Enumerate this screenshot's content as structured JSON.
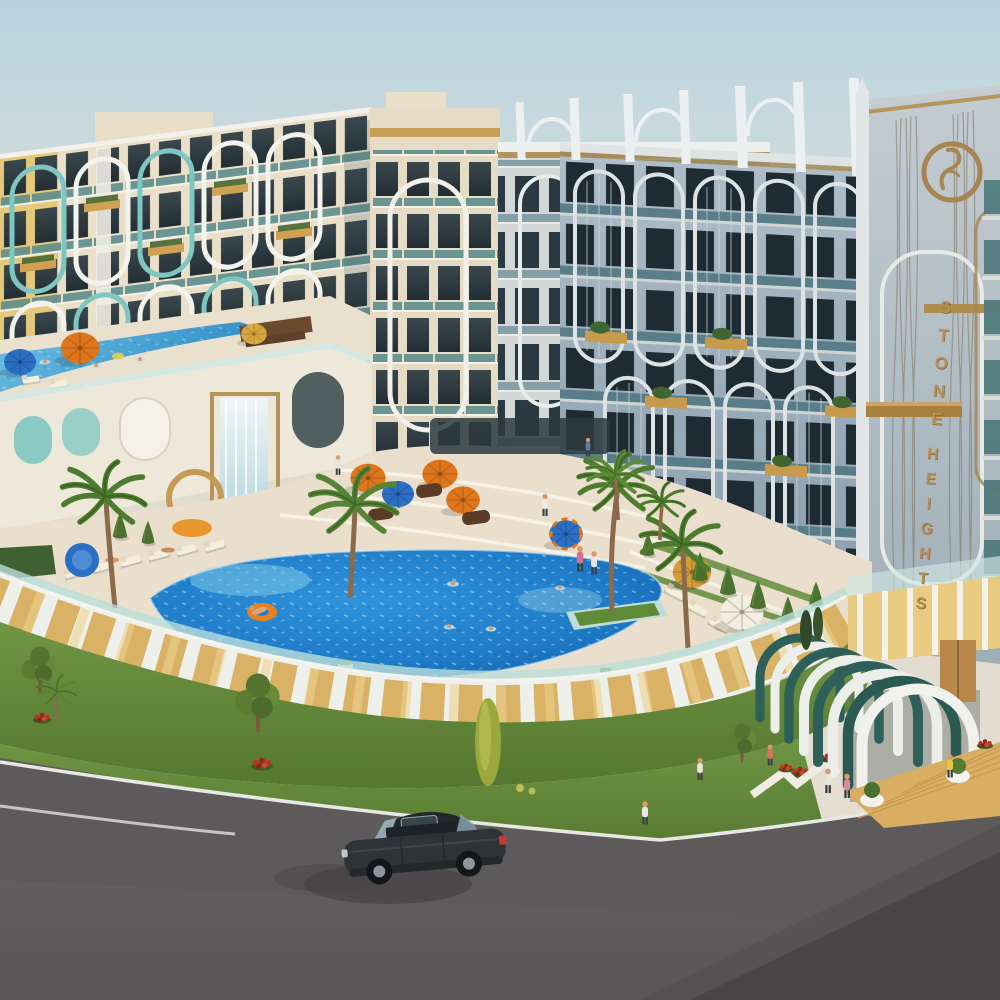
{
  "scene": {
    "kind": "3d-architectural-rendering",
    "subject": "Stone Heights resort apartment complex, aerial exterior view with swimming pools, palm landscaping, arched facades, entrance arch tunnel and road with a car"
  },
  "sign": {
    "word1": "STONE",
    "word2": "HEIGHTS",
    "color": "#b78f52"
  },
  "logo": {
    "name": "stone-heights-ring-emblem",
    "color": "#a8854e"
  },
  "palette": {
    "sky_top": "#b9d3e0",
    "sky_horizon": "#ded9cf",
    "facade_cream": "#eadfc8",
    "facade_yellow": "#e3c573",
    "facade_shadow_blue": "#a2b3c0",
    "tower_grey": "#b3bfc7",
    "accent_teal": "#7ec7c0",
    "balcony_glass": "#5d8d8c",
    "planter_wood": "#cfa253",
    "pool_shallow": "#72c5e2",
    "pool_mid": "#2f93dc",
    "pool_deep": "#135ca8",
    "deck_stone": "#eadfcc",
    "grass": "#628a39",
    "wall_wood": "#d9b266",
    "entrance_teal": "#2e6059",
    "asphalt": "#5d5a5b",
    "car_body": "#2e3336",
    "umbrella_orange": "#e0761c",
    "umbrella_blue": "#2a6fc4",
    "umbrella_white": "#f2eee2",
    "flower_red": "#c23022",
    "gold_trim": "#b5955c"
  },
  "objects": [
    "apartment-building-left-wing",
    "apartment-building-center",
    "apartment-building-right-wing",
    "brand-tower",
    "upper-terrace-pool",
    "waterfall-feature",
    "main-pool",
    "pool-palm-island",
    "sun-umbrellas",
    "sun-loungers",
    "perimeter-panel-wall",
    "entrance-arch-tunnel",
    "wooden-entrance-deck",
    "landscaped-lawn",
    "palm-trees",
    "red-flower-beds",
    "asphalt-road",
    "dark-sedan-car",
    "people"
  ]
}
